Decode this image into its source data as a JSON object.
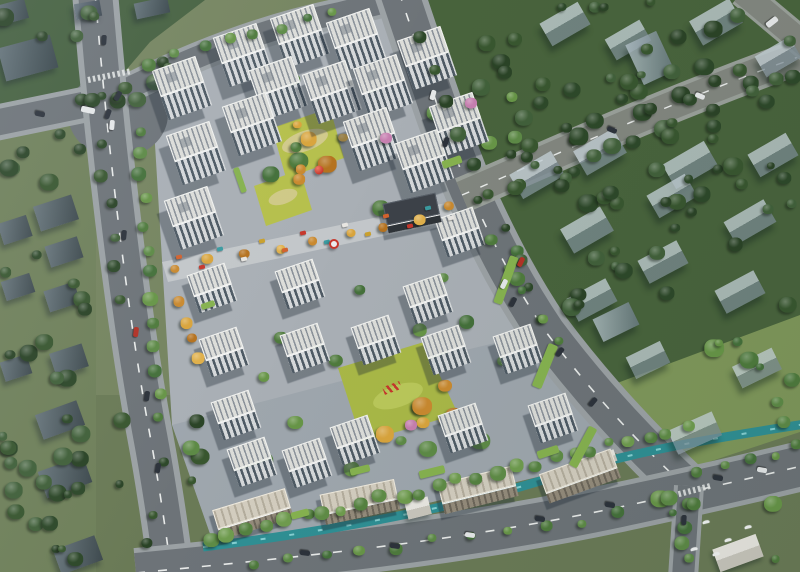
{
  "scene": {
    "description": "Aerial bird's-eye architectural rendering of a residential compound masterplan with white apartment towers, central gardens, a commercial street, surrounding roads, a canal and translucent context buildings among trees",
    "colors": {
      "bg_base": "#75845f",
      "forest_tl": "#45603f",
      "forest_ne": "#48633c",
      "lawn_ne": "#7f975a",
      "left_zone": "#6f805a",
      "bottom_zone": "#6a7a56",
      "pavement": "#a9afb5",
      "pavement_dark": "#969ea6",
      "garden": "#b6c04c",
      "garden2": "#a9b847",
      "garden_path": "#d6cb96",
      "street": "#c3c7ca",
      "road": "#6d7378",
      "road_minor": "#82867f",
      "road_edge": "#9aa09a",
      "sidewalk": "#9ba1a4",
      "lane": "#e9ebea",
      "canal": "#2f8f94",
      "canal_glint": "#8fd7d8",
      "roof": "#dcddd9",
      "roof_stripe": "#8b929a",
      "parapet": "#f1f2f0",
      "facade_dark": "#4e5a64",
      "facade_light": "#d5d8da",
      "low_roof": "#d3cdbf",
      "low_face": "#948b7b",
      "dark_roof": "#3c4148",
      "dark_face": "#2e3338",
      "ghost_lit": "rgba(197,209,215,0.78)",
      "ghost_shade": "rgba(126,142,152,0.72)",
      "shadow": "rgba(28,38,50,0.36)",
      "lawn_strip": "#86b24f",
      "accent_red": "#c6372c",
      "pink": "#c77fb0",
      "car_dark": "#2c323b",
      "car_white": "#e6e8e9",
      "car_red": "#b23226"
    },
    "palettes": {
      "dark": [
        "#2d4829",
        "#38562f",
        "#2a4326",
        "#41603a"
      ],
      "mid": [
        "#4e7a3c",
        "#5d8a46",
        "#44703a",
        "#679547"
      ],
      "light": [
        "#5f8c46",
        "#6f9c4e",
        "#558240"
      ],
      "autumn": [
        "#c9892f",
        "#d9a43c",
        "#b5721f",
        "#e0b04a"
      ]
    },
    "tower_types": {
      "tall": {
        "w": 46,
        "roof": 27,
        "face": 25
      },
      "mid": {
        "w": 40,
        "roof": 22,
        "face": 18
      },
      "low": {
        "w": 76,
        "roof": 20,
        "face": 11
      },
      "dark": {
        "w": 54,
        "roof": 22,
        "face": 8
      }
    },
    "towers": [
      [
        243,
        55,
        "tall"
      ],
      [
        300,
        36,
        "tall"
      ],
      [
        356,
        40,
        "tall"
      ],
      [
        427,
        58,
        "tall"
      ],
      [
        182,
        88,
        "tall"
      ],
      [
        278,
        88,
        "tall"
      ],
      [
        332,
        92,
        "tall"
      ],
      [
        383,
        86,
        "tall"
      ],
      [
        459,
        124,
        "tall"
      ],
      [
        196,
        153,
        "tall"
      ],
      [
        252,
        124,
        "tall"
      ],
      [
        373,
        139,
        "tall"
      ],
      [
        424,
        161,
        "tall"
      ],
      [
        194,
        218,
        "tall"
      ],
      [
        300,
        284,
        "mid"
      ],
      [
        460,
        232,
        "mid"
      ],
      [
        428,
        299,
        "mid"
      ],
      [
        518,
        349,
        "mid"
      ],
      [
        305,
        348,
        "mid"
      ],
      [
        376,
        340,
        "mid"
      ],
      [
        446,
        350,
        "mid"
      ],
      [
        212,
        288,
        "mid"
      ],
      [
        224,
        352,
        "mid"
      ],
      [
        236,
        415,
        "mid"
      ],
      [
        252,
        462,
        "mid"
      ],
      [
        355,
        440,
        "mid"
      ],
      [
        463,
        428,
        "mid"
      ],
      [
        307,
        463,
        "mid"
      ],
      [
        553,
        418,
        "mid"
      ],
      [
        253,
        514,
        "low",
        -17
      ],
      [
        360,
        502,
        "low",
        -12
      ],
      [
        478,
        490,
        "low",
        -14
      ],
      [
        580,
        476,
        "low",
        -20
      ],
      [
        412,
        213,
        "dark",
        -12
      ]
    ],
    "ghosts": [
      [
        28,
        58,
        54,
        34,
        -15,
        "dark"
      ],
      [
        12,
        12,
        30,
        20,
        -15,
        "dark"
      ],
      [
        88,
        10,
        26,
        16,
        -10,
        "dark"
      ],
      [
        152,
        8,
        34,
        16,
        -12,
        "dark"
      ],
      [
        56,
        213,
        40,
        26,
        -18,
        "dark"
      ],
      [
        64,
        252,
        34,
        22,
        -18,
        "dark"
      ],
      [
        15,
        230,
        30,
        22,
        -18,
        "dark"
      ],
      [
        62,
        297,
        32,
        22,
        -18,
        "dark"
      ],
      [
        18,
        287,
        30,
        20,
        -18,
        "dark"
      ],
      [
        69,
        360,
        34,
        24,
        -18,
        "dark"
      ],
      [
        16,
        368,
        28,
        20,
        -18,
        "dark"
      ],
      [
        60,
        420,
        44,
        26,
        -20,
        "dark"
      ],
      [
        65,
        477,
        48,
        28,
        -20,
        "dark"
      ],
      [
        78,
        555,
        44,
        26,
        -20,
        "dark"
      ],
      [
        565,
        24,
        44,
        26,
        -30,
        "gable"
      ],
      [
        628,
        40,
        40,
        24,
        -30,
        "gable"
      ],
      [
        716,
        22,
        46,
        28,
        -30,
        "gable"
      ],
      [
        778,
        57,
        40,
        24,
        -30,
        "gable"
      ],
      [
        650,
        58,
        34,
        44,
        -25,
        "box"
      ],
      [
        537,
        175,
        48,
        28,
        -30,
        "gable"
      ],
      [
        600,
        152,
        46,
        28,
        -30,
        "gable"
      ],
      [
        690,
        165,
        48,
        28,
        -30,
        "gable"
      ],
      [
        773,
        155,
        44,
        26,
        -30,
        "gable"
      ],
      [
        587,
        230,
        46,
        28,
        -30,
        "gable"
      ],
      [
        672,
        196,
        44,
        26,
        -30,
        "gable"
      ],
      [
        750,
        222,
        46,
        26,
        -30,
        "gable"
      ],
      [
        592,
        300,
        44,
        26,
        -28,
        "gable"
      ],
      [
        663,
        262,
        44,
        26,
        -28,
        "gable"
      ],
      [
        740,
        292,
        44,
        26,
        -28,
        "gable"
      ],
      [
        616,
        322,
        40,
        25,
        -26,
        "box"
      ],
      [
        648,
        360,
        38,
        24,
        -26,
        "gable"
      ],
      [
        695,
        433,
        48,
        26,
        -24,
        "gable"
      ],
      [
        757,
        368,
        44,
        24,
        -26,
        "gable"
      ],
      [
        738,
        553,
        46,
        24,
        -20,
        "white"
      ],
      [
        418,
        508,
        24,
        18,
        -14,
        "white"
      ],
      [
        607,
        458,
        18,
        12,
        -20,
        "white"
      ]
    ],
    "tree_rows": [
      [
        138,
        128,
        162,
        418,
        13,
        6,
        "mid"
      ],
      [
        152,
        62,
        332,
        12,
        8,
        6,
        "mid"
      ],
      [
        180,
        300,
        198,
        360,
        4,
        6,
        "autumn"
      ],
      [
        210,
        540,
        688,
        428,
        26,
        6,
        "light"
      ],
      [
        250,
        566,
        620,
        516,
        11,
        5,
        "mid"
      ],
      [
        480,
        202,
        790,
        78,
        9,
        6,
        "dark"
      ],
      [
        420,
        40,
        545,
        320,
        10,
        6,
        "dark"
      ],
      [
        100,
        140,
        120,
        300,
        6,
        6,
        "dark"
      ],
      [
        700,
        470,
        798,
        448,
        5,
        5,
        "mid"
      ],
      [
        176,
        268,
        452,
        210,
        9,
        5,
        "autumn"
      ],
      [
        490,
        240,
        560,
        340,
        5,
        5,
        "mid"
      ]
    ],
    "tree_areas": [
      [
        470,
        0,
        160,
        190,
        26,
        "dark",
        11
      ],
      [
        560,
        110,
        235,
        210,
        36,
        "dark",
        7
      ],
      [
        620,
        0,
        175,
        120,
        20,
        "dark",
        23
      ],
      [
        0,
        0,
        200,
        112,
        18,
        "dark",
        5
      ],
      [
        0,
        130,
        92,
        430,
        26,
        "dark",
        13
      ],
      [
        0,
        418,
        205,
        148,
        18,
        "dark",
        29
      ],
      [
        620,
        490,
        175,
        75,
        10,
        "mid",
        17
      ],
      [
        695,
        318,
        100,
        105,
        8,
        "mid",
        19
      ],
      [
        185,
        70,
        345,
        420,
        40,
        "mid",
        3
      ],
      [
        265,
        110,
        80,
        95,
        6,
        "autumn",
        31
      ],
      [
        340,
        352,
        120,
        85,
        6,
        "autumn",
        37
      ]
    ],
    "lawns": [
      [
        452,
        162,
        20,
        8,
        -19
      ],
      [
        506,
        280,
        9,
        50,
        20
      ],
      [
        545,
        366,
        10,
        46,
        22
      ],
      [
        583,
        447,
        9,
        44,
        28
      ],
      [
        432,
        472,
        26,
        8,
        -14
      ],
      [
        300,
        514,
        18,
        7,
        -15
      ],
      [
        360,
        470,
        20,
        7,
        -14
      ],
      [
        548,
        452,
        22,
        8,
        -18
      ],
      [
        208,
        305,
        14,
        6,
        -19
      ],
      [
        240,
        180,
        6,
        26,
        -19
      ]
    ],
    "stalls": {
      "x1": 180,
      "y1": 264,
      "x2": 450,
      "y2": 211,
      "n": 14,
      "colors": [
        "#d2622e",
        "#c6372c",
        "#3a9aa0",
        "#e8e6e2",
        "#caa12e"
      ]
    },
    "pinks": [
      [
        386,
        138
      ],
      [
        411,
        425
      ],
      [
        471,
        103
      ]
    ],
    "cars": [
      [
        104,
        40,
        4,
        "car_dark"
      ],
      [
        112,
        125,
        5,
        "car_white"
      ],
      [
        124,
        235,
        6,
        "car_dark"
      ],
      [
        136,
        332,
        7,
        "car_red"
      ],
      [
        147,
        396,
        8,
        "car_dark"
      ],
      [
        158,
        468,
        9,
        "car_dark"
      ],
      [
        118,
        96,
        30,
        "car_dark"
      ],
      [
        108,
        114,
        20,
        "car_dark"
      ],
      [
        40,
        114,
        102,
        "car_dark"
      ],
      [
        88,
        110,
        102,
        "car_white",
        6,
        14
      ],
      [
        433,
        95,
        16,
        "car_white"
      ],
      [
        446,
        142,
        18,
        "car_dark"
      ],
      [
        521,
        262,
        26,
        "car_red"
      ],
      [
        504,
        284,
        26,
        "car_white"
      ],
      [
        513,
        302,
        27,
        "car_dark"
      ],
      [
        560,
        352,
        38,
        "car_dark"
      ],
      [
        593,
        402,
        40,
        "car_dark"
      ],
      [
        305,
        553,
        97,
        "car_dark"
      ],
      [
        395,
        546,
        97,
        "car_dark"
      ],
      [
        470,
        535,
        98,
        "car_white"
      ],
      [
        540,
        519,
        99,
        "car_dark"
      ],
      [
        610,
        505,
        100,
        "car_dark"
      ],
      [
        718,
        478,
        100,
        "car_dark"
      ],
      [
        762,
        470,
        100,
        "car_white"
      ],
      [
        612,
        130,
        112,
        "car_dark"
      ],
      [
        700,
        96,
        112,
        "car_white"
      ],
      [
        772,
        22,
        52,
        "car_white",
        6,
        13
      ],
      [
        684,
        520,
        3,
        "car_dark"
      ]
    ],
    "birds": [
      [
        706,
        522
      ],
      [
        728,
        540
      ],
      [
        694,
        549
      ],
      [
        748,
        527
      ],
      [
        716,
        554
      ]
    ],
    "sculptures": {
      "ball": [
        319,
        170
      ],
      "disc": [
        334,
        244
      ],
      "canopy": [
        392,
        388
      ]
    }
  }
}
